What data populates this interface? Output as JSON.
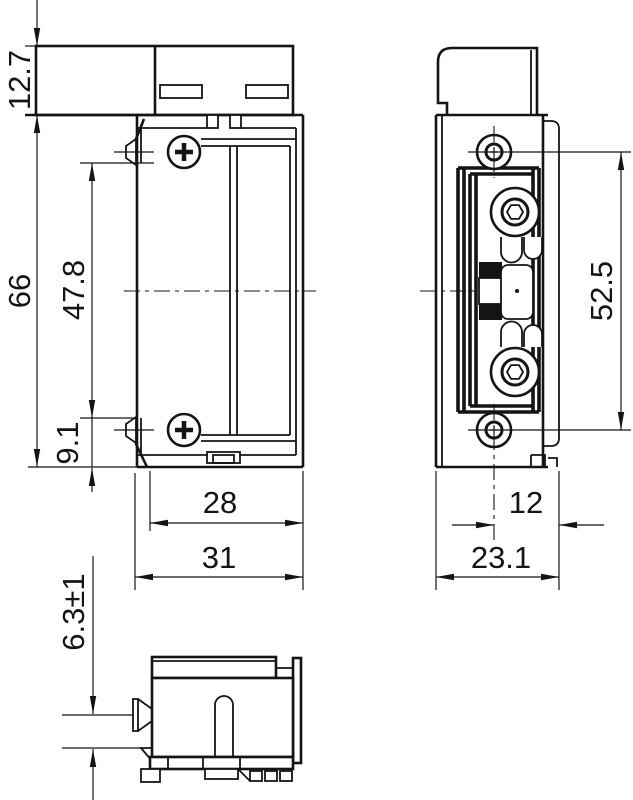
{
  "colors": {
    "line": "#141414",
    "background": "#ffffff"
  },
  "views": {
    "front": {
      "dims": {
        "housing_height": "12.7",
        "total_height": "66",
        "keeper_span": "47.8",
        "bottom_offset": "9.1",
        "inner_width": "28",
        "total_width": "31"
      }
    },
    "side": {
      "dims": {
        "hole_spacing": "52.5",
        "center_to_face": "12",
        "depth": "23.1"
      }
    },
    "bottom": {
      "dims": {
        "screw_protrusion": "6.3±1"
      }
    }
  }
}
